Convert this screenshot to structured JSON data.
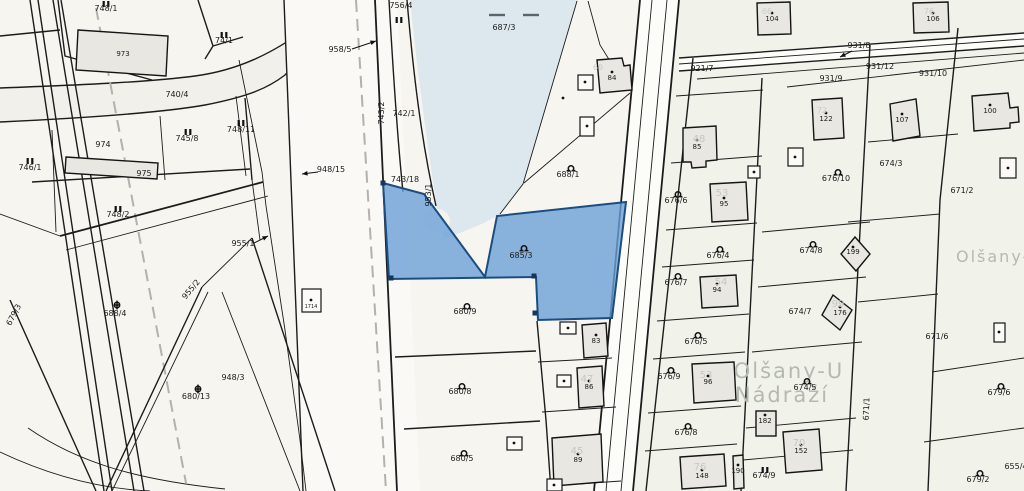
{
  "map": {
    "canvas": {
      "width": 1024,
      "height": 491
    },
    "colors": {
      "background": "#f7f5f0",
      "east_background": "#f1f2ea",
      "water": "#dce8ee",
      "road_fill": "#fbfaf6",
      "selected_fill": "#6ca0d7",
      "selected_stroke": "#1c4d80",
      "boundary_line": "#1c1c1c",
      "dashed_line": "#b3b1ab",
      "watermark_gray": "#c6c8c2",
      "placename_gray": "#b5b9b3"
    },
    "selected_parcel": "685/3",
    "water_parcel": "687/3",
    "placenames": [
      {
        "text": "Olšany-U",
        "x": 789,
        "y": 378,
        "size": 21,
        "anchor": "middle"
      },
      {
        "text": "Nádraží",
        "x": 782,
        "y": 402,
        "size": 21,
        "anchor": "middle"
      },
      {
        "text": "Olšany-u nád",
        "x": 956,
        "y": 262,
        "size": 16,
        "anchor": "start"
      }
    ],
    "labels": [
      {
        "x": 106,
        "y": 11,
        "t": "748/1",
        "c": "lp"
      },
      {
        "x": 123,
        "y": 56,
        "t": "973",
        "c": "lb"
      },
      {
        "x": 177,
        "y": 97,
        "t": "740/4",
        "c": "lp"
      },
      {
        "x": 224,
        "y": 43,
        "t": "74/1",
        "c": "lp"
      },
      {
        "x": 187,
        "y": 141,
        "t": "745/8",
        "c": "lp"
      },
      {
        "x": 241,
        "y": 132,
        "t": "748/11",
        "c": "lp"
      },
      {
        "x": 103,
        "y": 147,
        "t": "974",
        "c": "lp"
      },
      {
        "x": 144,
        "y": 176,
        "t": "975",
        "c": "lp"
      },
      {
        "x": 118,
        "y": 217,
        "t": "748/2",
        "c": "lp"
      },
      {
        "x": 30,
        "y": 170,
        "t": "746/1",
        "c": "lp"
      },
      {
        "x": 193,
        "y": 291,
        "t": "955/2",
        "c": "lp",
        "r": -50
      },
      {
        "x": 16,
        "y": 316,
        "t": "679/3",
        "c": "lp",
        "r": -62
      },
      {
        "x": 115,
        "y": 316,
        "t": "688/4",
        "c": "lp"
      },
      {
        "x": 196,
        "y": 399,
        "t": "680/13",
        "c": "lp"
      },
      {
        "x": 233,
        "y": 380,
        "t": "948/3",
        "c": "lp"
      },
      {
        "x": 331,
        "y": 172,
        "t": "948/15",
        "c": "lp"
      },
      {
        "x": 340,
        "y": 52,
        "t": "958/5",
        "c": "lp"
      },
      {
        "x": 243,
        "y": 246,
        "t": "955/1",
        "c": "lp"
      },
      {
        "x": 401,
        "y": 8,
        "t": "756/4",
        "c": "lp"
      },
      {
        "x": 404,
        "y": 116,
        "t": "742/1",
        "c": "lp"
      },
      {
        "x": 384,
        "y": 113,
        "t": "743/2",
        "c": "lp",
        "r": -90
      },
      {
        "x": 405,
        "y": 182,
        "t": "743/18",
        "c": "lp"
      },
      {
        "x": 431,
        "y": 195,
        "t": "953/1",
        "c": "lp",
        "r": -90
      },
      {
        "x": 504,
        "y": 30,
        "t": "687/3",
        "c": "lp"
      },
      {
        "x": 521,
        "y": 258,
        "t": "685/3",
        "c": "lp"
      },
      {
        "x": 568,
        "y": 177,
        "t": "688/1",
        "c": "lp"
      },
      {
        "x": 465,
        "y": 314,
        "t": "680/9",
        "c": "lp"
      },
      {
        "x": 460,
        "y": 394,
        "t": "680/8",
        "c": "lp"
      },
      {
        "x": 462,
        "y": 461,
        "t": "680/5",
        "c": "lp"
      },
      {
        "x": 676,
        "y": 203,
        "t": "676/6",
        "c": "lp"
      },
      {
        "x": 718,
        "y": 258,
        "t": "676/4",
        "c": "lp"
      },
      {
        "x": 676,
        "y": 285,
        "t": "676/7",
        "c": "lp"
      },
      {
        "x": 696,
        "y": 344,
        "t": "676/5",
        "c": "lp"
      },
      {
        "x": 669,
        "y": 379,
        "t": "676/9",
        "c": "lp"
      },
      {
        "x": 686,
        "y": 435,
        "t": "676/8",
        "c": "lp"
      },
      {
        "x": 764,
        "y": 478,
        "t": "674/9",
        "c": "lp"
      },
      {
        "x": 805,
        "y": 390,
        "t": "674/5",
        "c": "lp"
      },
      {
        "x": 800,
        "y": 314,
        "t": "674/7",
        "c": "lp"
      },
      {
        "x": 811,
        "y": 253,
        "t": "674/8",
        "c": "lp"
      },
      {
        "x": 836,
        "y": 181,
        "t": "676/10",
        "c": "lp"
      },
      {
        "x": 891,
        "y": 166,
        "t": "674/3",
        "c": "lp"
      },
      {
        "x": 962,
        "y": 193,
        "t": "671/2",
        "c": "lp"
      },
      {
        "x": 937,
        "y": 339,
        "t": "671/6",
        "c": "lp"
      },
      {
        "x": 999,
        "y": 395,
        "t": "679/6",
        "c": "lp"
      },
      {
        "x": 978,
        "y": 482,
        "t": "679/2",
        "c": "lp"
      },
      {
        "x": 1016,
        "y": 469,
        "t": "655/4",
        "c": "lp"
      },
      {
        "x": 869,
        "y": 409,
        "t": "671/1",
        "c": "lp",
        "r": -88
      },
      {
        "x": 702,
        "y": 71,
        "t": "921/7",
        "c": "lp"
      },
      {
        "x": 859,
        "y": 48,
        "t": "931/8",
        "c": "lp"
      },
      {
        "x": 880,
        "y": 69,
        "t": "931/12",
        "c": "lp"
      },
      {
        "x": 831,
        "y": 81,
        "t": "931/9",
        "c": "lp"
      },
      {
        "x": 933,
        "y": 76,
        "t": "931/10",
        "c": "lp"
      },
      {
        "x": 612,
        "y": 80,
        "t": "84",
        "c": "lb"
      },
      {
        "x": 697,
        "y": 149,
        "t": "85",
        "c": "lb"
      },
      {
        "x": 724,
        "y": 206,
        "t": "95",
        "c": "lb"
      },
      {
        "x": 717,
        "y": 292,
        "t": "94",
        "c": "lb"
      },
      {
        "x": 708,
        "y": 384,
        "t": "96",
        "c": "lb"
      },
      {
        "x": 596,
        "y": 343,
        "t": "83",
        "c": "lb"
      },
      {
        "x": 589,
        "y": 389,
        "t": "86",
        "c": "lb"
      },
      {
        "x": 578,
        "y": 462,
        "t": "89",
        "c": "lb"
      },
      {
        "x": 772,
        "y": 21,
        "t": "104",
        "c": "lb"
      },
      {
        "x": 933,
        "y": 21,
        "t": "106",
        "c": "lb"
      },
      {
        "x": 902,
        "y": 122,
        "t": "107",
        "c": "lb"
      },
      {
        "x": 990,
        "y": 113,
        "t": "100",
        "c": "lb"
      },
      {
        "x": 826,
        "y": 121,
        "t": "122",
        "c": "lb"
      },
      {
        "x": 840,
        "y": 315,
        "t": "176",
        "c": "lb"
      },
      {
        "x": 765,
        "y": 423,
        "t": "182",
        "c": "lb"
      },
      {
        "x": 801,
        "y": 453,
        "t": "152",
        "c": "lb"
      },
      {
        "x": 702,
        "y": 478,
        "t": "148",
        "c": "lb"
      },
      {
        "x": 738,
        "y": 473,
        "t": "190",
        "c": "lb"
      },
      {
        "x": 853,
        "y": 254,
        "t": "199",
        "c": "lb"
      },
      {
        "x": 311,
        "y": 308,
        "t": "1714",
        "c": "lt"
      },
      {
        "x": 598,
        "y": 70,
        "t": "69",
        "c": "lws"
      },
      {
        "x": 699,
        "y": 142,
        "t": "48",
        "c": "lw"
      },
      {
        "x": 722,
        "y": 196,
        "t": "53",
        "c": "lw"
      },
      {
        "x": 721,
        "y": 285,
        "t": "54",
        "c": "lw"
      },
      {
        "x": 706,
        "y": 378,
        "t": "53",
        "c": "lw"
      },
      {
        "x": 587,
        "y": 382,
        "t": "47",
        "c": "lw"
      },
      {
        "x": 577,
        "y": 454,
        "t": "45",
        "c": "lw"
      },
      {
        "x": 799,
        "y": 446,
        "t": "70",
        "c": "lw"
      },
      {
        "x": 700,
        "y": 470,
        "t": "76",
        "c": "lw"
      },
      {
        "x": 838,
        "y": 307,
        "t": "99",
        "c": "lw"
      },
      {
        "x": 767,
        "y": 14,
        "t": "66",
        "c": "lws"
      },
      {
        "x": 929,
        "y": 14,
        "t": "76",
        "c": "lws"
      },
      {
        "x": 822,
        "y": 113,
        "t": "72",
        "c": "lws"
      }
    ],
    "symbols": [
      {
        "t": "ii",
        "x": 106,
        "y": 4
      },
      {
        "t": "ii",
        "x": 224,
        "y": 35
      },
      {
        "t": "ii",
        "x": 188,
        "y": 132
      },
      {
        "t": "ii",
        "x": 241,
        "y": 123
      },
      {
        "t": "ii",
        "x": 118,
        "y": 209
      },
      {
        "t": "ii",
        "x": 30,
        "y": 161
      },
      {
        "t": "ii",
        "x": 399,
        "y": 20
      },
      {
        "t": "ii",
        "x": 765,
        "y": 470
      },
      {
        "t": "omega",
        "x": 524,
        "y": 248
      },
      {
        "t": "omega",
        "x": 571,
        "y": 168
      },
      {
        "t": "omega",
        "x": 467,
        "y": 306
      },
      {
        "t": "omega",
        "x": 462,
        "y": 386
      },
      {
        "t": "omega",
        "x": 464,
        "y": 453
      },
      {
        "t": "omega",
        "x": 678,
        "y": 194
      },
      {
        "t": "omega",
        "x": 720,
        "y": 249
      },
      {
        "t": "omega",
        "x": 678,
        "y": 276
      },
      {
        "t": "omega",
        "x": 698,
        "y": 335
      },
      {
        "t": "omega",
        "x": 671,
        "y": 370
      },
      {
        "t": "omega",
        "x": 688,
        "y": 426
      },
      {
        "t": "omega",
        "x": 807,
        "y": 381
      },
      {
        "t": "omega",
        "x": 813,
        "y": 244
      },
      {
        "t": "omega",
        "x": 838,
        "y": 172
      },
      {
        "t": "omega",
        "x": 1001,
        "y": 386
      },
      {
        "t": "omega",
        "x": 980,
        "y": 473
      },
      {
        "t": "cc",
        "x": 117,
        "y": 305
      },
      {
        "t": "cc",
        "x": 198,
        "y": 389
      },
      {
        "t": "wdash",
        "x": 497,
        "y": 15
      },
      {
        "t": "wdash",
        "x": 531,
        "y": 15
      },
      {
        "t": "dot",
        "x": 612,
        "y": 72
      },
      {
        "t": "dot",
        "x": 697,
        "y": 140
      },
      {
        "t": "dot",
        "x": 724,
        "y": 198
      },
      {
        "t": "dot",
        "x": 717,
        "y": 284
      },
      {
        "t": "dot",
        "x": 708,
        "y": 376
      },
      {
        "t": "dot",
        "x": 596,
        "y": 335
      },
      {
        "t": "dot",
        "x": 589,
        "y": 381
      },
      {
        "t": "dot",
        "x": 578,
        "y": 454
      },
      {
        "t": "dot",
        "x": 772,
        "y": 13
      },
      {
        "t": "dot",
        "x": 933,
        "y": 13
      },
      {
        "t": "dot",
        "x": 902,
        "y": 114
      },
      {
        "t": "dot",
        "x": 990,
        "y": 105
      },
      {
        "t": "dot",
        "x": 826,
        "y": 113
      },
      {
        "t": "dot",
        "x": 840,
        "y": 307
      },
      {
        "t": "dot",
        "x": 765,
        "y": 415
      },
      {
        "t": "dot",
        "x": 801,
        "y": 445
      },
      {
        "t": "dot",
        "x": 702,
        "y": 470
      },
      {
        "t": "dot",
        "x": 738,
        "y": 465
      },
      {
        "t": "dot",
        "x": 853,
        "y": 247
      },
      {
        "t": "dot",
        "x": 311,
        "y": 300
      },
      {
        "t": "dot",
        "x": 585,
        "y": 82
      },
      {
        "t": "dot",
        "x": 587,
        "y": 126
      },
      {
        "t": "dot",
        "x": 754,
        "y": 172
      },
      {
        "t": "dot",
        "x": 795,
        "y": 157
      },
      {
        "t": "dot",
        "x": 568,
        "y": 328
      },
      {
        "t": "dot",
        "x": 564,
        "y": 381
      },
      {
        "t": "dot",
        "x": 514,
        "y": 443
      },
      {
        "t": "dot",
        "x": 999,
        "y": 332
      },
      {
        "t": "dot",
        "x": 1008,
        "y": 168
      },
      {
        "t": "dot",
        "x": 554,
        "y": 485
      },
      {
        "t": "dot",
        "x": 563,
        "y": 98
      }
    ],
    "arrows": [
      {
        "x1": 318,
        "y1": 172,
        "x2": 302,
        "y2": 174
      },
      {
        "x1": 352,
        "y1": 49,
        "x2": 376,
        "y2": 41
      },
      {
        "x1": 852,
        "y1": 51,
        "x2": 840,
        "y2": 57
      },
      {
        "x1": 254,
        "y1": 243,
        "x2": 268,
        "y2": 236
      }
    ],
    "markers": [
      {
        "x": 383,
        "y": 183
      },
      {
        "x": 391,
        "y": 278
      },
      {
        "x": 534,
        "y": 276
      },
      {
        "x": 535,
        "y": 313
      }
    ]
  }
}
